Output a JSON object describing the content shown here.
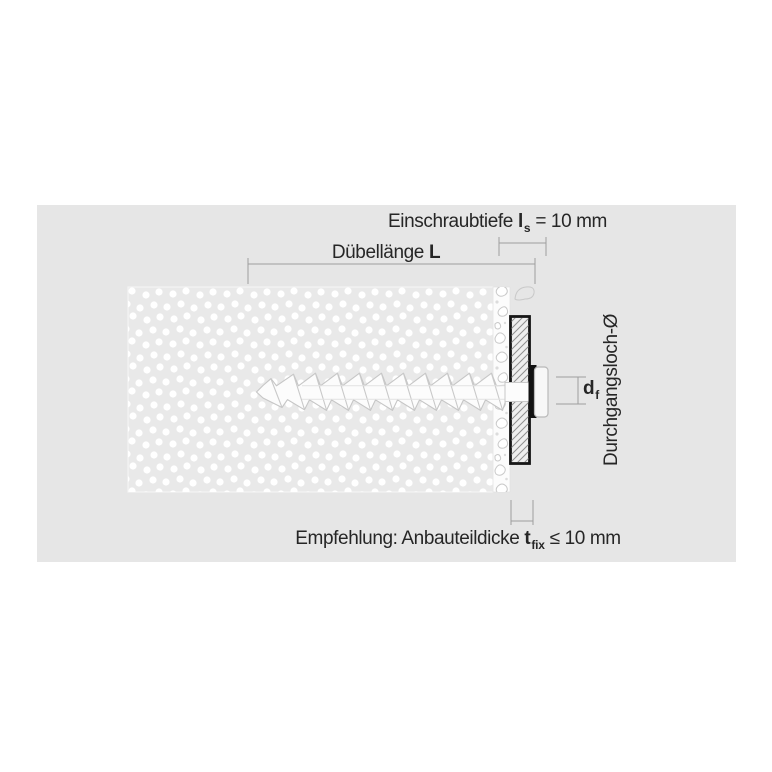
{
  "window": {
    "width": 772,
    "height": 772
  },
  "colors": {
    "page_bg": "#ffffff",
    "panel_bg": "#e6e6e6",
    "insulation_bg": "#e9e9e9",
    "dot": "#ffffff",
    "plate_border": "#161616",
    "hatch_line": "#8f8f8f",
    "through_hole_fill": "#121212",
    "dimension_line": "#9e9e9e",
    "text": "#262626",
    "screw_outline": "#c6c6c6",
    "screw_fill": "#fcfcfc"
  },
  "labels": {
    "einschraubtiefe": {
      "text": "Einschraubtiefe",
      "symbol": "l",
      "subscript": "s",
      "value": "= 10 mm"
    },
    "duebellaenge": {
      "text": "Dübellänge",
      "symbol": "L"
    },
    "durchgangsloch": {
      "text": "Durchgangsloch-Ø"
    },
    "df": {
      "symbol": "d",
      "subscript": "f"
    },
    "empfehlung": {
      "text": "Empfehlung: Anbauteildicke",
      "symbol": "t",
      "subscript": "fix",
      "value": "≤ 10 mm"
    }
  }
}
